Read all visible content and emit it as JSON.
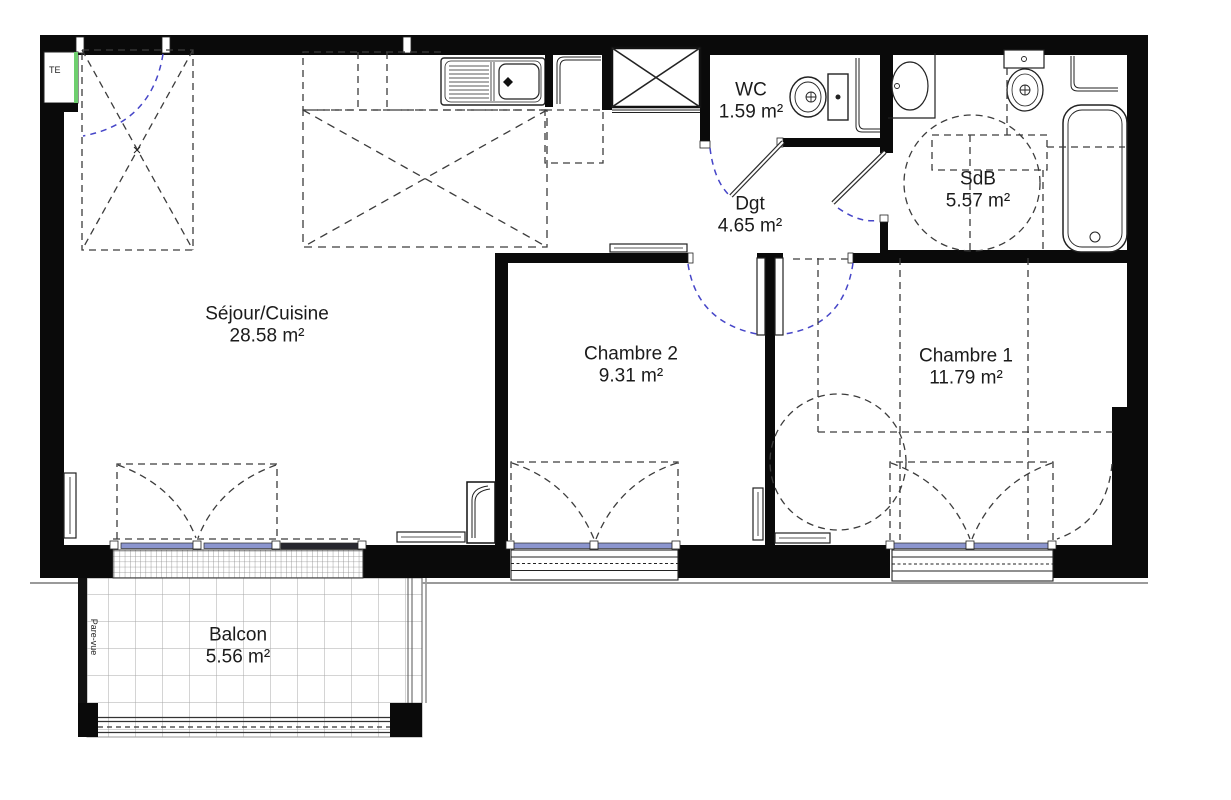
{
  "plan": {
    "type": "apartment-floor-plan",
    "rooms": [
      {
        "id": "sejour-cuisine",
        "name": "Séjour/Cuisine",
        "area": "28.58 m²"
      },
      {
        "id": "chambre-2",
        "name": "Chambre 2",
        "area": "9.31 m²"
      },
      {
        "id": "chambre-1",
        "name": "Chambre 1",
        "area": "11.79 m²"
      },
      {
        "id": "wc",
        "name": "WC",
        "area": "1.59 m²"
      },
      {
        "id": "degagement",
        "name": "Dgt",
        "area": "4.65 m²"
      },
      {
        "id": "salle-de-bain",
        "name": "SdB",
        "area": "5.57 m²"
      },
      {
        "id": "balcon",
        "name": "Balcon",
        "area": "5.56 m²"
      }
    ],
    "annotations": {
      "electrical_panel": "TE",
      "privacy_screen": "Pare-vue"
    },
    "fixtures": [
      "kitchen-sink",
      "kitchen-counter",
      "tall-unit",
      "technical-duct",
      "toilet",
      "washbasin-counter",
      "pedestal-washbasin",
      "bathtub",
      "radiators",
      "wardrobe",
      "double-bed",
      "french-door",
      "casement-windows",
      "balcony-railing"
    ],
    "colors": {
      "wall": "#0a0a0a",
      "door_swing_blue": "#4646c8",
      "glazing_blue": "#8b95ce",
      "fixed_glazing_dark": "#26262e",
      "te_green": "#6fcf6f",
      "furniture_dash": "#3c3c3c",
      "balcony_grid": "#a8a8a8"
    }
  }
}
